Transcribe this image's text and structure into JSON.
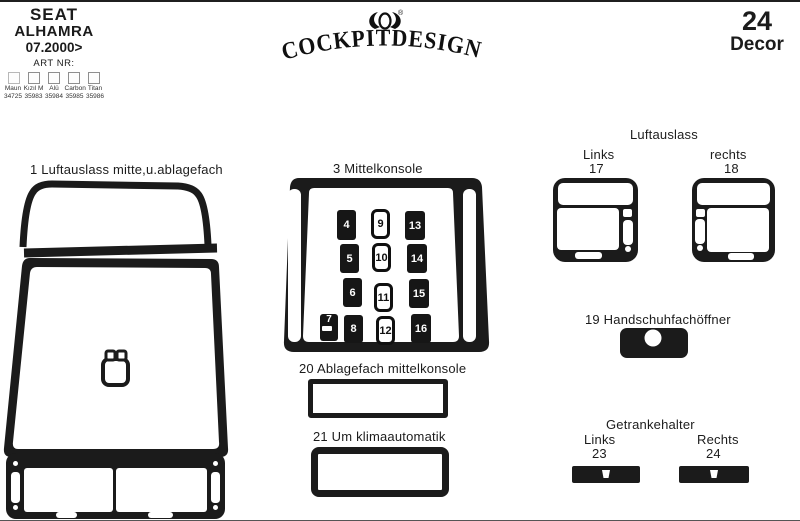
{
  "header": {
    "brand_line1": "SEAT",
    "brand_line2": "ALHAMRA",
    "model_year": "07.2000>",
    "art_nr_label": "ART NR:",
    "colors": [
      {
        "name": "Maun",
        "nr": "34725"
      },
      {
        "name": "Kızıl M",
        "nr": "35983"
      },
      {
        "name": "Alü",
        "nr": "35984"
      },
      {
        "name": "Carbon",
        "nr": "35985"
      },
      {
        "name": "Titan",
        "nr": "35986"
      }
    ],
    "logo_text": "COCKPITDESIGN",
    "logo_reg": "®",
    "decor_count": "24",
    "decor_label": "Decor"
  },
  "parts": {
    "part1_label": "1 Luftauslass mitte,u.ablagefach",
    "part2_label": "2  Lichtniveauregulierung",
    "part3_label": "3  Mittelkonsole",
    "vents_title": "Luftauslass",
    "vent_left_label": "Links",
    "vent_left_nr": "17",
    "vent_right_label": "rechts",
    "vent_right_nr": "18",
    "part19_label": "19  Handschuhfachöffner",
    "part20_label": "20  Ablagefach  mittelkonsole",
    "part21_label": "21  Um klimaautomatik",
    "part22_label": "22",
    "cupholder_title": "Getrankehalter",
    "cup_left_label": "Links",
    "cup_left_nr": "23",
    "cup_right_label": "Rechts",
    "cup_right_nr": "24"
  },
  "console_buttons": [
    {
      "label": "4"
    },
    {
      "label": "5"
    },
    {
      "label": "6"
    },
    {
      "label": "7"
    },
    {
      "label": "8"
    },
    {
      "label": "9"
    },
    {
      "label": "10"
    },
    {
      "label": "11"
    },
    {
      "label": "12"
    },
    {
      "label": "13"
    },
    {
      "label": "14"
    },
    {
      "label": "15"
    },
    {
      "label": "16"
    }
  ],
  "colors": {
    "ink": "#1b1b1b",
    "paper": "#ffffff"
  }
}
